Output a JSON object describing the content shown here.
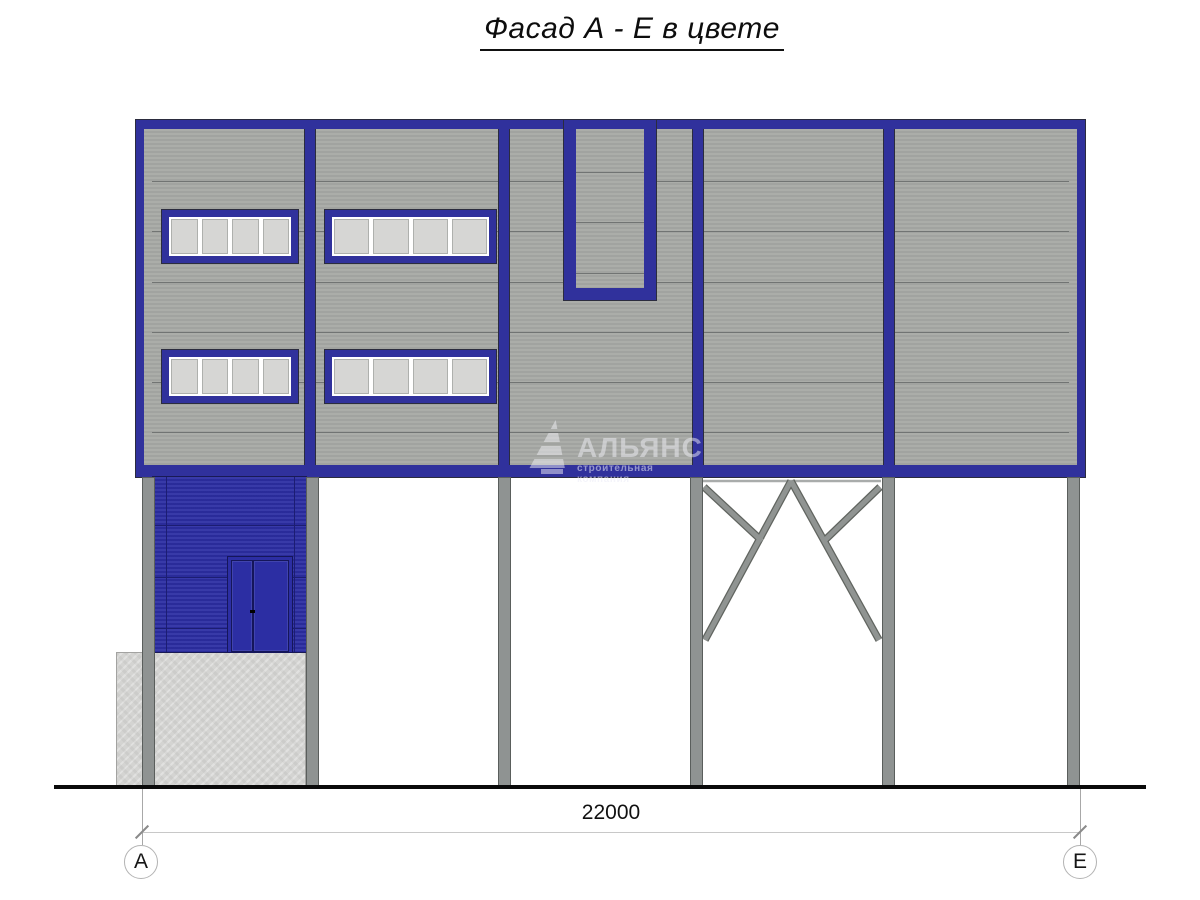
{
  "title": {
    "text": "Фасад А - Е в цвете"
  },
  "watermark": {
    "brand": "АЛЬЯНС",
    "tagline": "строительная компания"
  },
  "dimension": {
    "total": "22000"
  },
  "grid": {
    "left_label": "А",
    "right_label": "Е"
  },
  "colors": {
    "frame_blue": "#30319c",
    "lower_wall_blue": "#2c2ea3",
    "panel_gray": "#abada9",
    "panel_gray_dark": "#a1a3a0",
    "seam_gray": "#717473",
    "column_gray": "#8f9392",
    "column_edge": "#5a5e5c",
    "glass_gray": "#d6d6d4",
    "concrete_gray": "#d4d4d2",
    "ground_black": "#0a0a0a",
    "dim_gray": "#c8c8c8",
    "ext_gray": "#a8a8a8",
    "outline_dark": "#2b2c3e",
    "door_edge": "#15165a",
    "wall_seam": "#1c1d72",
    "brace_dark": "#60645f",
    "brace_light": "#909492"
  }
}
